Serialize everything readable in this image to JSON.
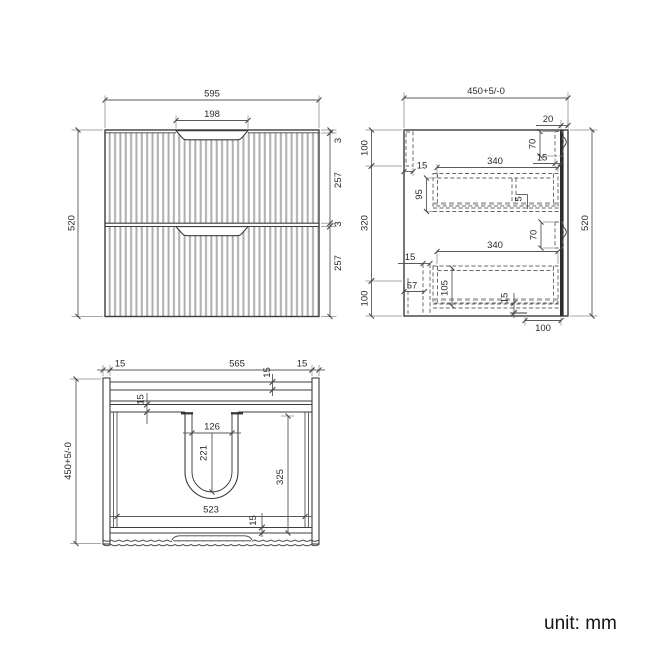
{
  "unit_label": "unit: mm",
  "front_view": {
    "width": "595",
    "handle_cutout": "198",
    "height": "520",
    "top_gap": "3",
    "drawer1_height": "257",
    "mid_gap": "3",
    "drawer2_height": "257"
  },
  "side_view": {
    "depth": "450+5/-0",
    "back_panel": "20",
    "top_section": "100",
    "mid_section": "320",
    "bottom_section": "100",
    "height": "520",
    "bracket_top": "70",
    "bracket_top_inset": "15",
    "top_rail": "15",
    "drawer1_depth": "340",
    "drawer1_height": "95",
    "divider": "5",
    "bracket_mid": "70",
    "drawer2_depth": "340",
    "front_inset": "15",
    "toe_space": "57",
    "drawer2_height": "105",
    "bottom_panel": "15",
    "base_clear": "100"
  },
  "plan_view": {
    "side_left": "15",
    "opening_width": "565",
    "side_right": "15",
    "depth": "450+5/-0",
    "back_rail": "15",
    "front_rail": "15",
    "cutout_width": "126",
    "cutout_depth": "221",
    "interior_depth": "325",
    "interior_width": "523",
    "bottom_rail": "15"
  }
}
